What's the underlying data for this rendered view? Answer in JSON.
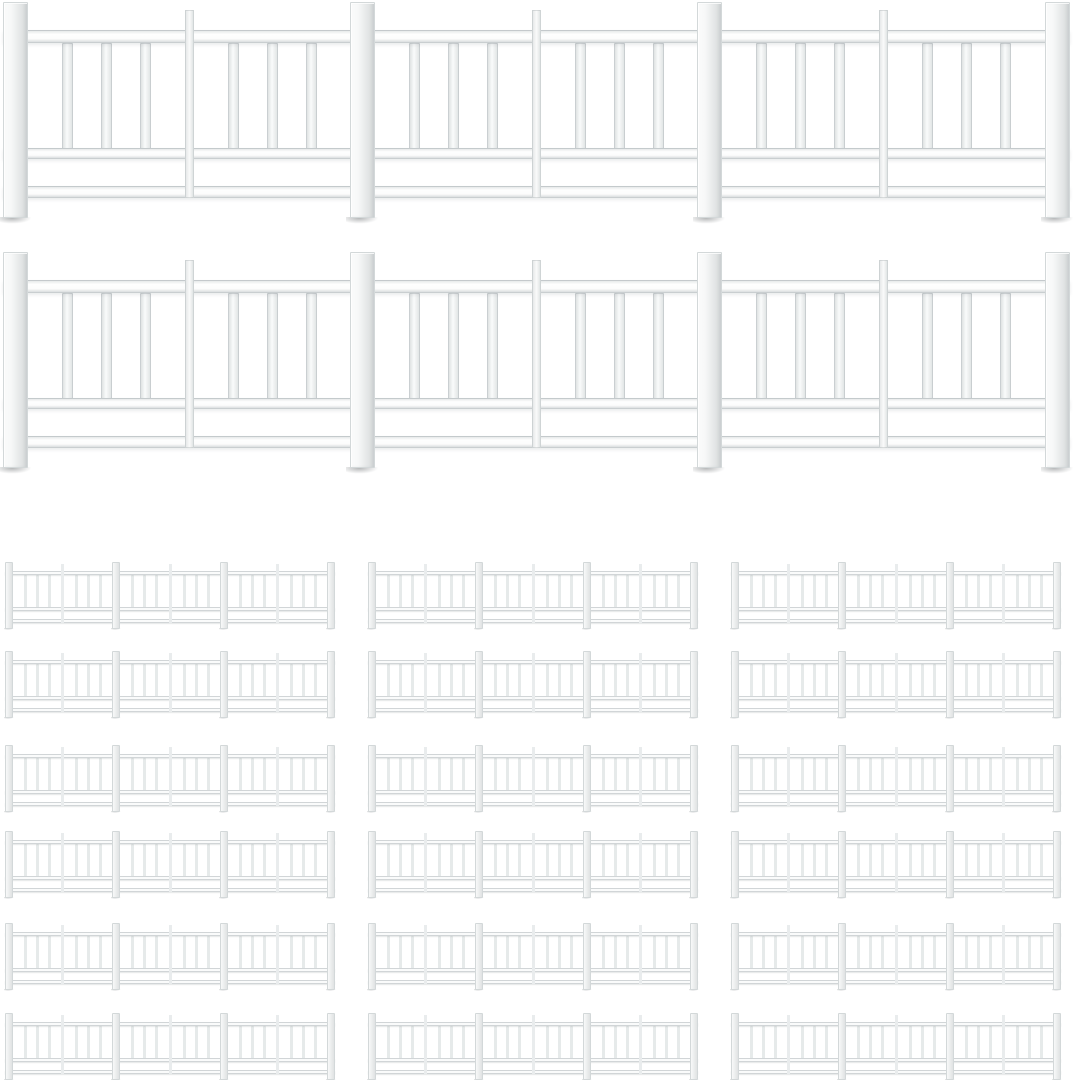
{
  "page": {
    "type": "product-image",
    "background_color": "#ffffff",
    "description": "Product photo of white vinyl fence rail panels on a plain white background: two full-width large panels stacked at the top and a grid of eighteen small panels (6 rows by 3 columns) below. No text is visible in the image."
  },
  "product": {
    "item_label": "white vinyl fence rail panel",
    "large_panels": {
      "count": 2,
      "label": "large white fence panel"
    },
    "small_panels": {
      "count": 18,
      "rows": 6,
      "columns": 3,
      "label": "small white fence panel"
    }
  },
  "fence_structure": {
    "sections": 3,
    "major_posts": 4,
    "intermediate_posts": 3,
    "balusters_per_half_section": 3,
    "balusters_total": 18,
    "rails": [
      "top",
      "middle",
      "bottom"
    ],
    "proportions": {
      "width": 1067,
      "height": 216,
      "post_w": 25,
      "post_x": [
        0,
        347,
        694,
        1042
      ],
      "inter_post_w": 9,
      "inter_post_top": 8,
      "top_rail": [
        28,
        41
      ],
      "mid_rail": [
        146,
        157
      ],
      "bottom_rail": [
        184,
        196
      ],
      "baluster_w": 11,
      "baluster_span": [
        41,
        150
      ],
      "baluster_fractions": [
        0.25,
        0.5,
        0.75
      ]
    },
    "colors": {
      "background": "#ffffff",
      "rail_fill": "#fafbfb",
      "rail_edge": "#dce1e2",
      "baluster_fill": "#f0f3f3",
      "baluster_fill_small": "#e6eaea",
      "inter_fill": "#f2f4f4",
      "inter_fill_small": "#e9eced",
      "post_fill": "#eef0f0",
      "post_edge": "#d3d8d9",
      "foot_shadow": "rgba(60,65,68,0.38)"
    }
  },
  "composition": {
    "canvas": {
      "width": 1073,
      "height": 1080
    },
    "large_panels": [
      {
        "x": 3,
        "y": 2
      },
      {
        "x": 3,
        "y": 252
      }
    ],
    "small_grid": {
      "col_x": [
        5,
        368,
        731
      ],
      "row_y": [
        562,
        651,
        745,
        831,
        923,
        1013
      ],
      "panel_width": 330
    }
  }
}
